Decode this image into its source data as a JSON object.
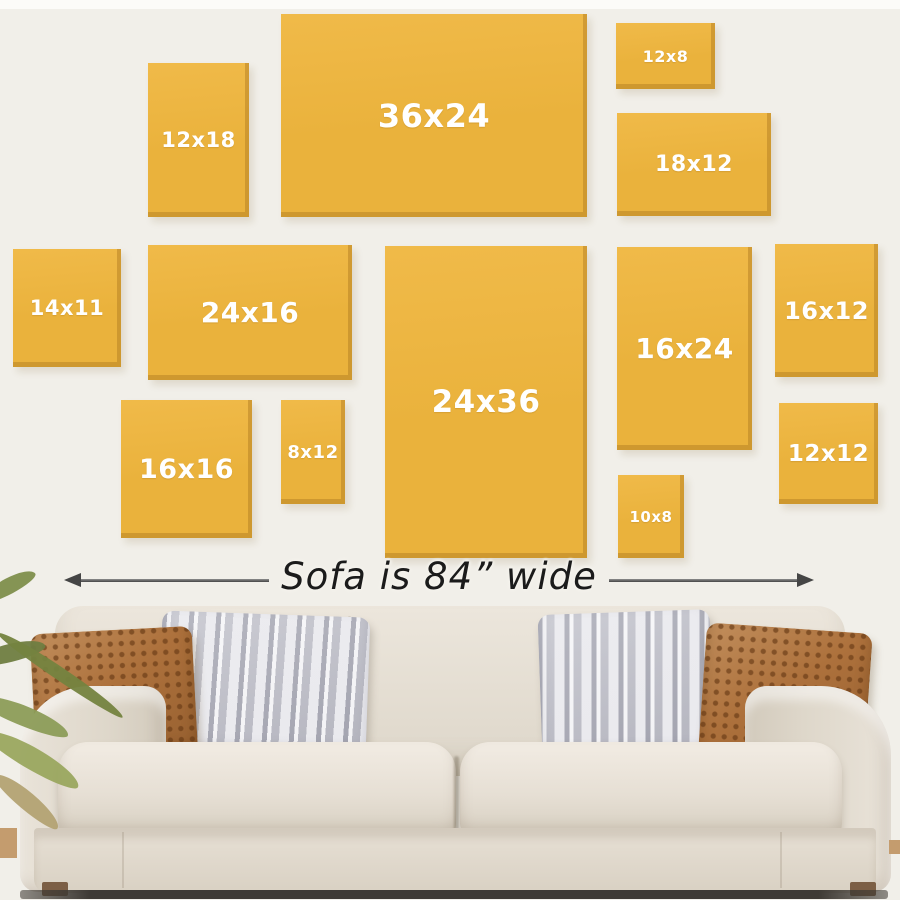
{
  "diagram": {
    "frames": [
      {
        "label": "12x18",
        "x": 148,
        "y": 63,
        "w": 101,
        "h": 154,
        "fs": 21
      },
      {
        "label": "36x24",
        "x": 281,
        "y": 14,
        "w": 306,
        "h": 203,
        "fs": 32
      },
      {
        "label": "12x8",
        "x": 616,
        "y": 23,
        "w": 99,
        "h": 66,
        "fs": 16
      },
      {
        "label": "18x12",
        "x": 617,
        "y": 113,
        "w": 154,
        "h": 103,
        "fs": 22
      },
      {
        "label": "14x11",
        "x": 13,
        "y": 249,
        "w": 108,
        "h": 118,
        "fs": 21
      },
      {
        "label": "24x16",
        "x": 148,
        "y": 245,
        "w": 204,
        "h": 135,
        "fs": 28
      },
      {
        "label": "24x36",
        "x": 385,
        "y": 246,
        "w": 202,
        "h": 312,
        "fs": 31
      },
      {
        "label": "16x24",
        "x": 617,
        "y": 247,
        "w": 135,
        "h": 203,
        "fs": 28
      },
      {
        "label": "16x12",
        "x": 775,
        "y": 244,
        "w": 103,
        "h": 133,
        "fs": 24
      },
      {
        "label": "16x16",
        "x": 121,
        "y": 400,
        "w": 131,
        "h": 138,
        "fs": 27
      },
      {
        "label": "8x12",
        "x": 281,
        "y": 400,
        "w": 64,
        "h": 104,
        "fs": 18
      },
      {
        "label": "10x8",
        "x": 618,
        "y": 475,
        "w": 66,
        "h": 83,
        "fs": 15
      },
      {
        "label": "12x12",
        "x": 779,
        "y": 403,
        "w": 99,
        "h": 101,
        "fs": 23
      }
    ],
    "frame_colors": {
      "fill": "#eab23c",
      "fill_light": "#f0ba49",
      "edge_shade": "#ac7820",
      "label_color": "#ffffff"
    }
  },
  "dimension": {
    "label": "Sofa is 84” wide",
    "line_color": "#454545",
    "text_color": "#1b1b1b"
  },
  "scene": {
    "wall_color": "#f1efe9",
    "top_strip_color": "#fcfbf8",
    "sofa_fabric_color": "#e7e0d5",
    "pillow_brown_color": "#ad713c",
    "pillow_gray_color": "#d8d7db",
    "plant_leaf_color": "#84934e",
    "floor_color": "#c49c6e",
    "leaves": [
      {
        "x": -20,
        "y": 578,
        "w": 58,
        "h": 16,
        "r": -28,
        "c": "#7e8e4c"
      },
      {
        "x": -26,
        "y": 644,
        "w": 72,
        "h": 18,
        "r": -14,
        "c": "#6f7d41"
      },
      {
        "x": -14,
        "y": 668,
        "w": 150,
        "h": 13,
        "r": 34,
        "c": "#74833f"
      },
      {
        "x": -24,
        "y": 706,
        "w": 96,
        "h": 20,
        "r": 22,
        "c": "#8c9c58"
      },
      {
        "x": -20,
        "y": 748,
        "w": 106,
        "h": 22,
        "r": 30,
        "c": "#9aa75f"
      },
      {
        "x": -14,
        "y": 792,
        "w": 82,
        "h": 18,
        "r": 40,
        "c": "#b3a273"
      }
    ]
  }
}
